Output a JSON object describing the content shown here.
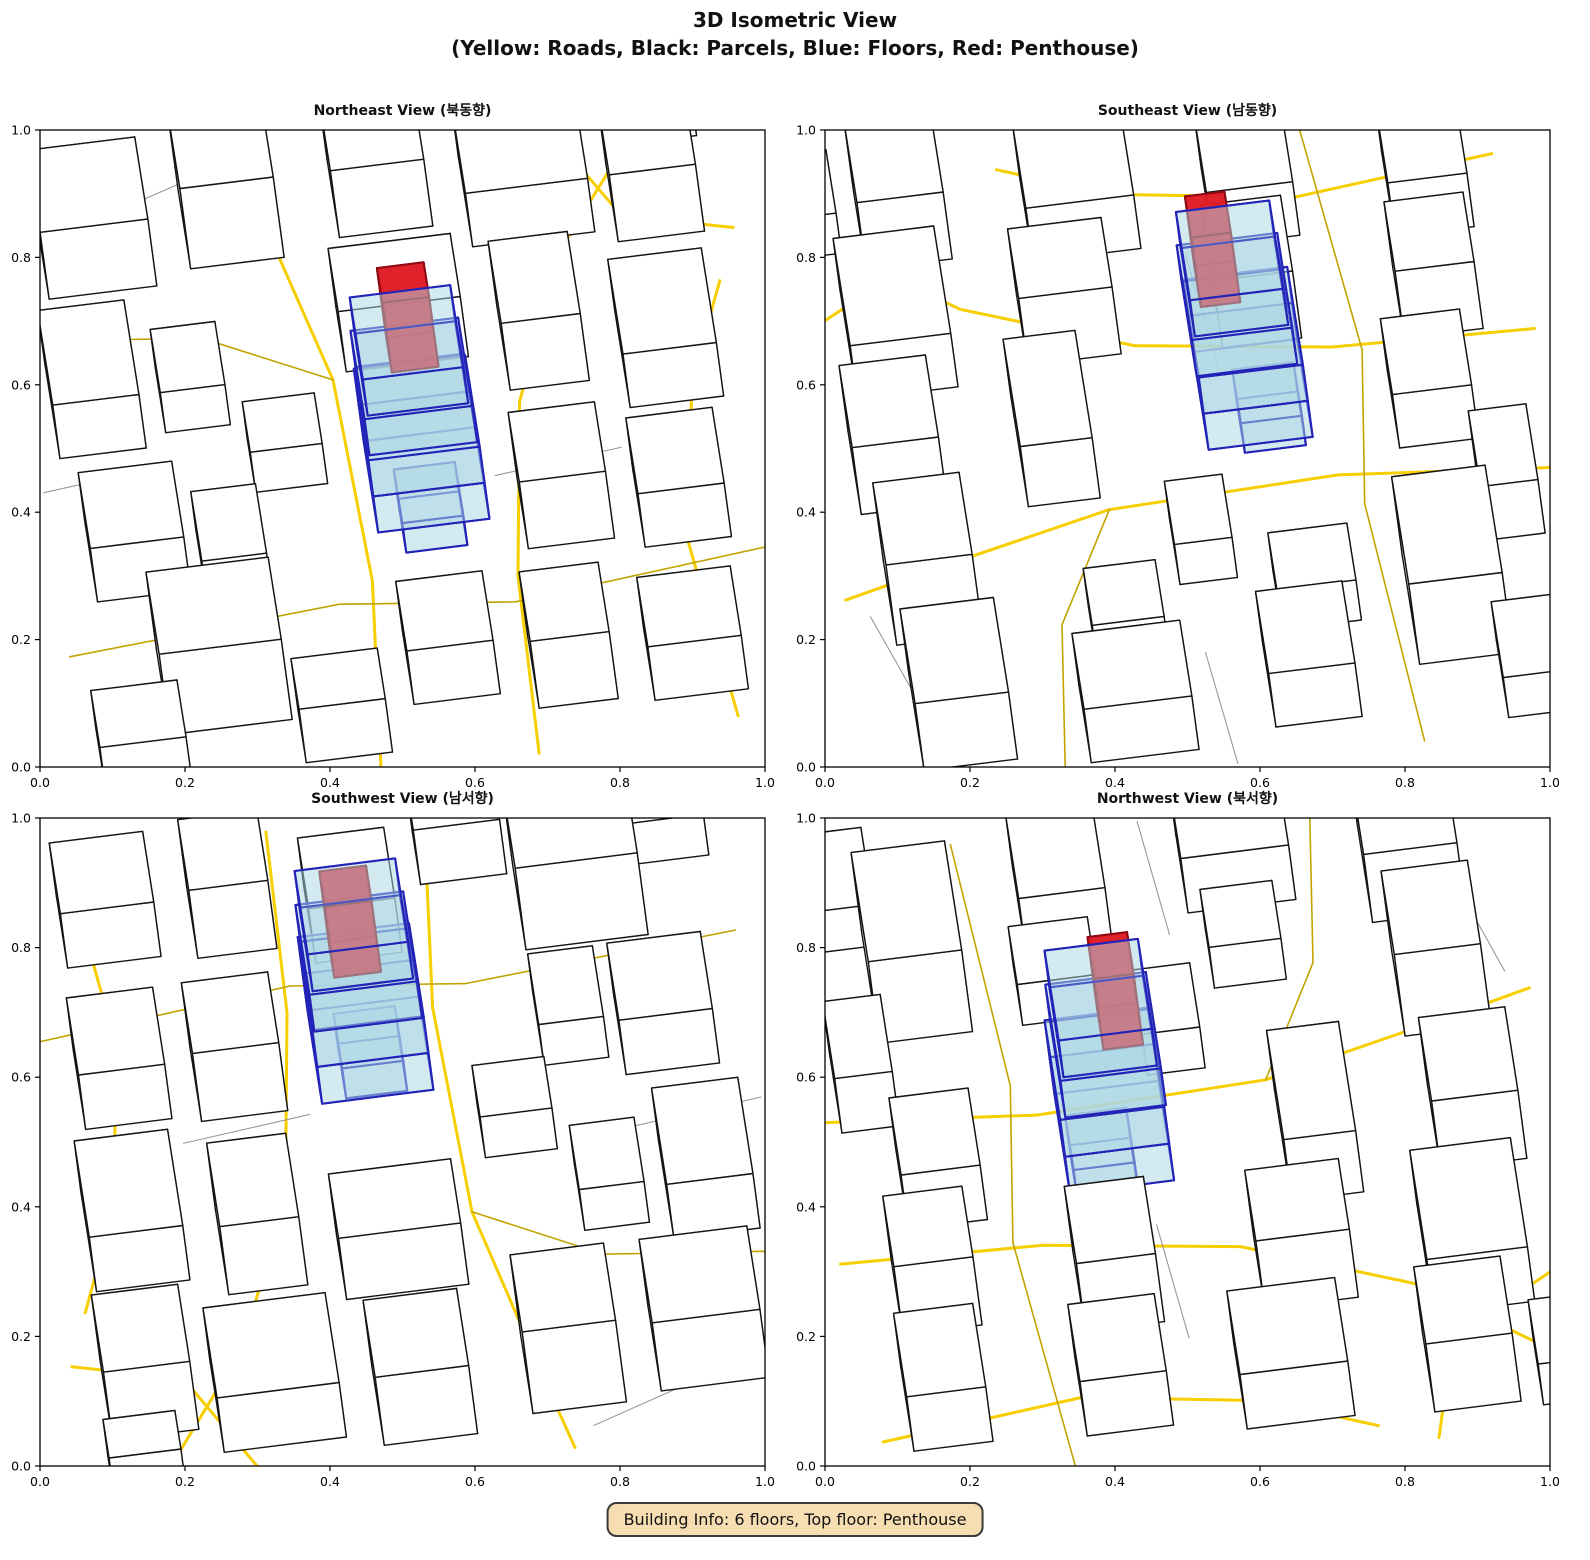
{
  "figure": {
    "title": "3D Isometric View",
    "subtitle": "(Yellow: Roads, Black: Parcels, Blue: Floors, Red: Penthouse)",
    "badge": "Building Info: 6 floors, Top floor: Penthouse"
  },
  "views": [
    {
      "id": "ne",
      "title": "Northeast View (북동향)",
      "angle": 8
    },
    {
      "id": "se",
      "title": "Southeast View (남동향)",
      "angle": 98
    },
    {
      "id": "sw",
      "title": "Southwest View (남서향)",
      "angle": 188
    },
    {
      "id": "nw",
      "title": "Northwest View (북서향)",
      "angle": 278
    }
  ],
  "axis": {
    "ticks": [
      0.0,
      0.2,
      0.4,
      0.6,
      0.8,
      1.0
    ],
    "tick_labels": [
      "0.0",
      "0.2",
      "0.4",
      "0.6",
      "0.8",
      "1.0"
    ],
    "range": [
      0.0,
      1.0
    ]
  },
  "colors": {
    "road_major": "#F7CE00",
    "road_minor": "#C2A300",
    "parcel_edge": "#141414",
    "parcel_fill": "#ffffff",
    "gray_line": "#999999",
    "floor_fill": "#ADD8E6",
    "floor_edge": "#2323B8",
    "penthouse_fill": "#E01B24",
    "penthouse_edge": "#8F0A12",
    "badge_bg": "#F6DEB2",
    "axis_color": "#000000"
  },
  "building_info": {
    "floors": 6,
    "top_floor": "Penthouse"
  },
  "chart_data": {
    "type": "3d-isometric-city",
    "title": "3D Isometric View",
    "subtitle": "(Yellow: Roads, Black: Parcels, Blue: Floors, Red: Penthouse)",
    "legend": {
      "yellow": "Roads",
      "black": "Parcels",
      "blue": "Floors",
      "red": "Penthouse"
    },
    "subplots": [
      "Northeast View (북동향)",
      "Southeast View (남동향)",
      "Southwest View (남서향)",
      "Northwest View (북서향)"
    ],
    "axis_range": [
      0.0,
      1.0
    ],
    "axis_ticks": [
      0.0,
      0.2,
      0.4,
      0.6,
      0.8,
      1.0
    ],
    "grid": false,
    "target_building": {
      "floors": 6,
      "top_floor": "Penthouse",
      "center": [
        0.525,
        0.4
      ]
    },
    "scene": {
      "buildings": [
        [
          0.05,
          0.8,
          0.15,
          0.13,
          0.05
        ],
        [
          0.25,
          0.82,
          0.13,
          0.12,
          0.06
        ],
        [
          0.46,
          0.84,
          0.13,
          0.12,
          0.05
        ],
        [
          0.64,
          0.8,
          0.17,
          0.14,
          0.04
        ],
        [
          0.84,
          0.78,
          0.12,
          0.12,
          0.05
        ],
        [
          0.03,
          0.55,
          0.12,
          0.15,
          0.04
        ],
        [
          0.18,
          0.57,
          0.09,
          0.1,
          0.03
        ],
        [
          0.44,
          0.63,
          0.17,
          0.1,
          0.045
        ],
        [
          0.66,
          0.57,
          0.11,
          0.13,
          0.05
        ],
        [
          0.82,
          0.52,
          0.13,
          0.15,
          0.04
        ],
        [
          0.05,
          0.32,
          0.13,
          0.12,
          0.04
        ],
        [
          0.2,
          0.3,
          0.09,
          0.11,
          0.03
        ],
        [
          0.12,
          0.1,
          0.17,
          0.13,
          0.06
        ],
        [
          0.65,
          0.32,
          0.12,
          0.11,
          0.05
        ],
        [
          0.81,
          0.3,
          0.12,
          0.12,
          0.04
        ],
        [
          0.46,
          0.1,
          0.12,
          0.11,
          0.04
        ],
        [
          0.63,
          0.07,
          0.11,
          0.11,
          0.05
        ],
        [
          0.79,
          0.06,
          0.13,
          0.11,
          0.04
        ],
        [
          0.29,
          0.46,
          0.1,
          0.08,
          0.03
        ],
        [
          0.02,
          0.03,
          0.12,
          0.09,
          0.03
        ],
        [
          0.3,
          0.03,
          0.12,
          0.08,
          0.04
        ],
        [
          0.87,
          0.93,
          0.1,
          0.06,
          0.03
        ]
      ],
      "roads": [
        {
          "kind": "major",
          "pts": [
            [
              0.4,
              0.0
            ],
            [
              0.43,
              0.3
            ],
            [
              0.42,
              0.62
            ],
            [
              0.35,
              0.92
            ],
            [
              0.33,
              1.0
            ]
          ]
        },
        {
          "kind": "major",
          "pts": [
            [
              0.62,
              0.0
            ],
            [
              0.63,
              0.28
            ],
            [
              0.67,
              0.55
            ],
            [
              0.76,
              0.78
            ],
            [
              0.9,
              0.97
            ]
          ]
        },
        {
          "kind": "major",
          "pts": [
            [
              0.9,
              0.02
            ],
            [
              0.87,
              0.3
            ],
            [
              0.91,
              0.55
            ],
            [
              0.97,
              0.7
            ]
          ]
        },
        {
          "kind": "major",
          "pts": [
            [
              0.75,
              1.0
            ],
            [
              0.85,
              0.82
            ],
            [
              1.0,
              0.78
            ]
          ]
        },
        {
          "kind": "minor",
          "pts": [
            [
              0.0,
              0.74
            ],
            [
              0.25,
              0.71
            ],
            [
              0.42,
              0.62
            ]
          ]
        },
        {
          "kind": "minor",
          "pts": [
            [
              0.0,
              0.24
            ],
            [
              0.38,
              0.27
            ],
            [
              0.62,
              0.24
            ],
            [
              1.0,
              0.28
            ]
          ]
        }
      ],
      "gray_lines": [
        [
          [
            0.0,
            0.5
          ],
          [
            0.18,
            0.52
          ]
        ],
        [
          [
            0.62,
            0.44
          ],
          [
            0.8,
            0.46
          ]
        ],
        [
          [
            0.18,
            0.93
          ],
          [
            0.3,
            0.97
          ]
        ]
      ],
      "target": {
        "center": [
          0.525,
          0.4
        ],
        "floors": [
          {
            "w": 0.085,
            "d": 0.085,
            "z": 0.0,
            "h": 0.022,
            "dx": 0.0,
            "dy": -0.02
          },
          {
            "w": 0.155,
            "d": 0.145,
            "z": 0.022,
            "h": 0.027,
            "dx": 0.0,
            "dy": 0.0
          },
          {
            "w": 0.155,
            "d": 0.145,
            "z": 0.049,
            "h": 0.027,
            "dx": 0.0,
            "dy": 0.0
          },
          {
            "w": 0.15,
            "d": 0.14,
            "z": 0.076,
            "h": 0.027,
            "dx": 0.0,
            "dy": 0.005
          },
          {
            "w": 0.14,
            "d": 0.13,
            "z": 0.103,
            "h": 0.027,
            "dx": 0.0,
            "dy": 0.005
          }
        ],
        "penthouse": {
          "w": 0.065,
          "d": 0.055,
          "z": 0.104,
          "h": 0.052,
          "dx": 0.005,
          "dy": 0.028
        }
      }
    }
  }
}
